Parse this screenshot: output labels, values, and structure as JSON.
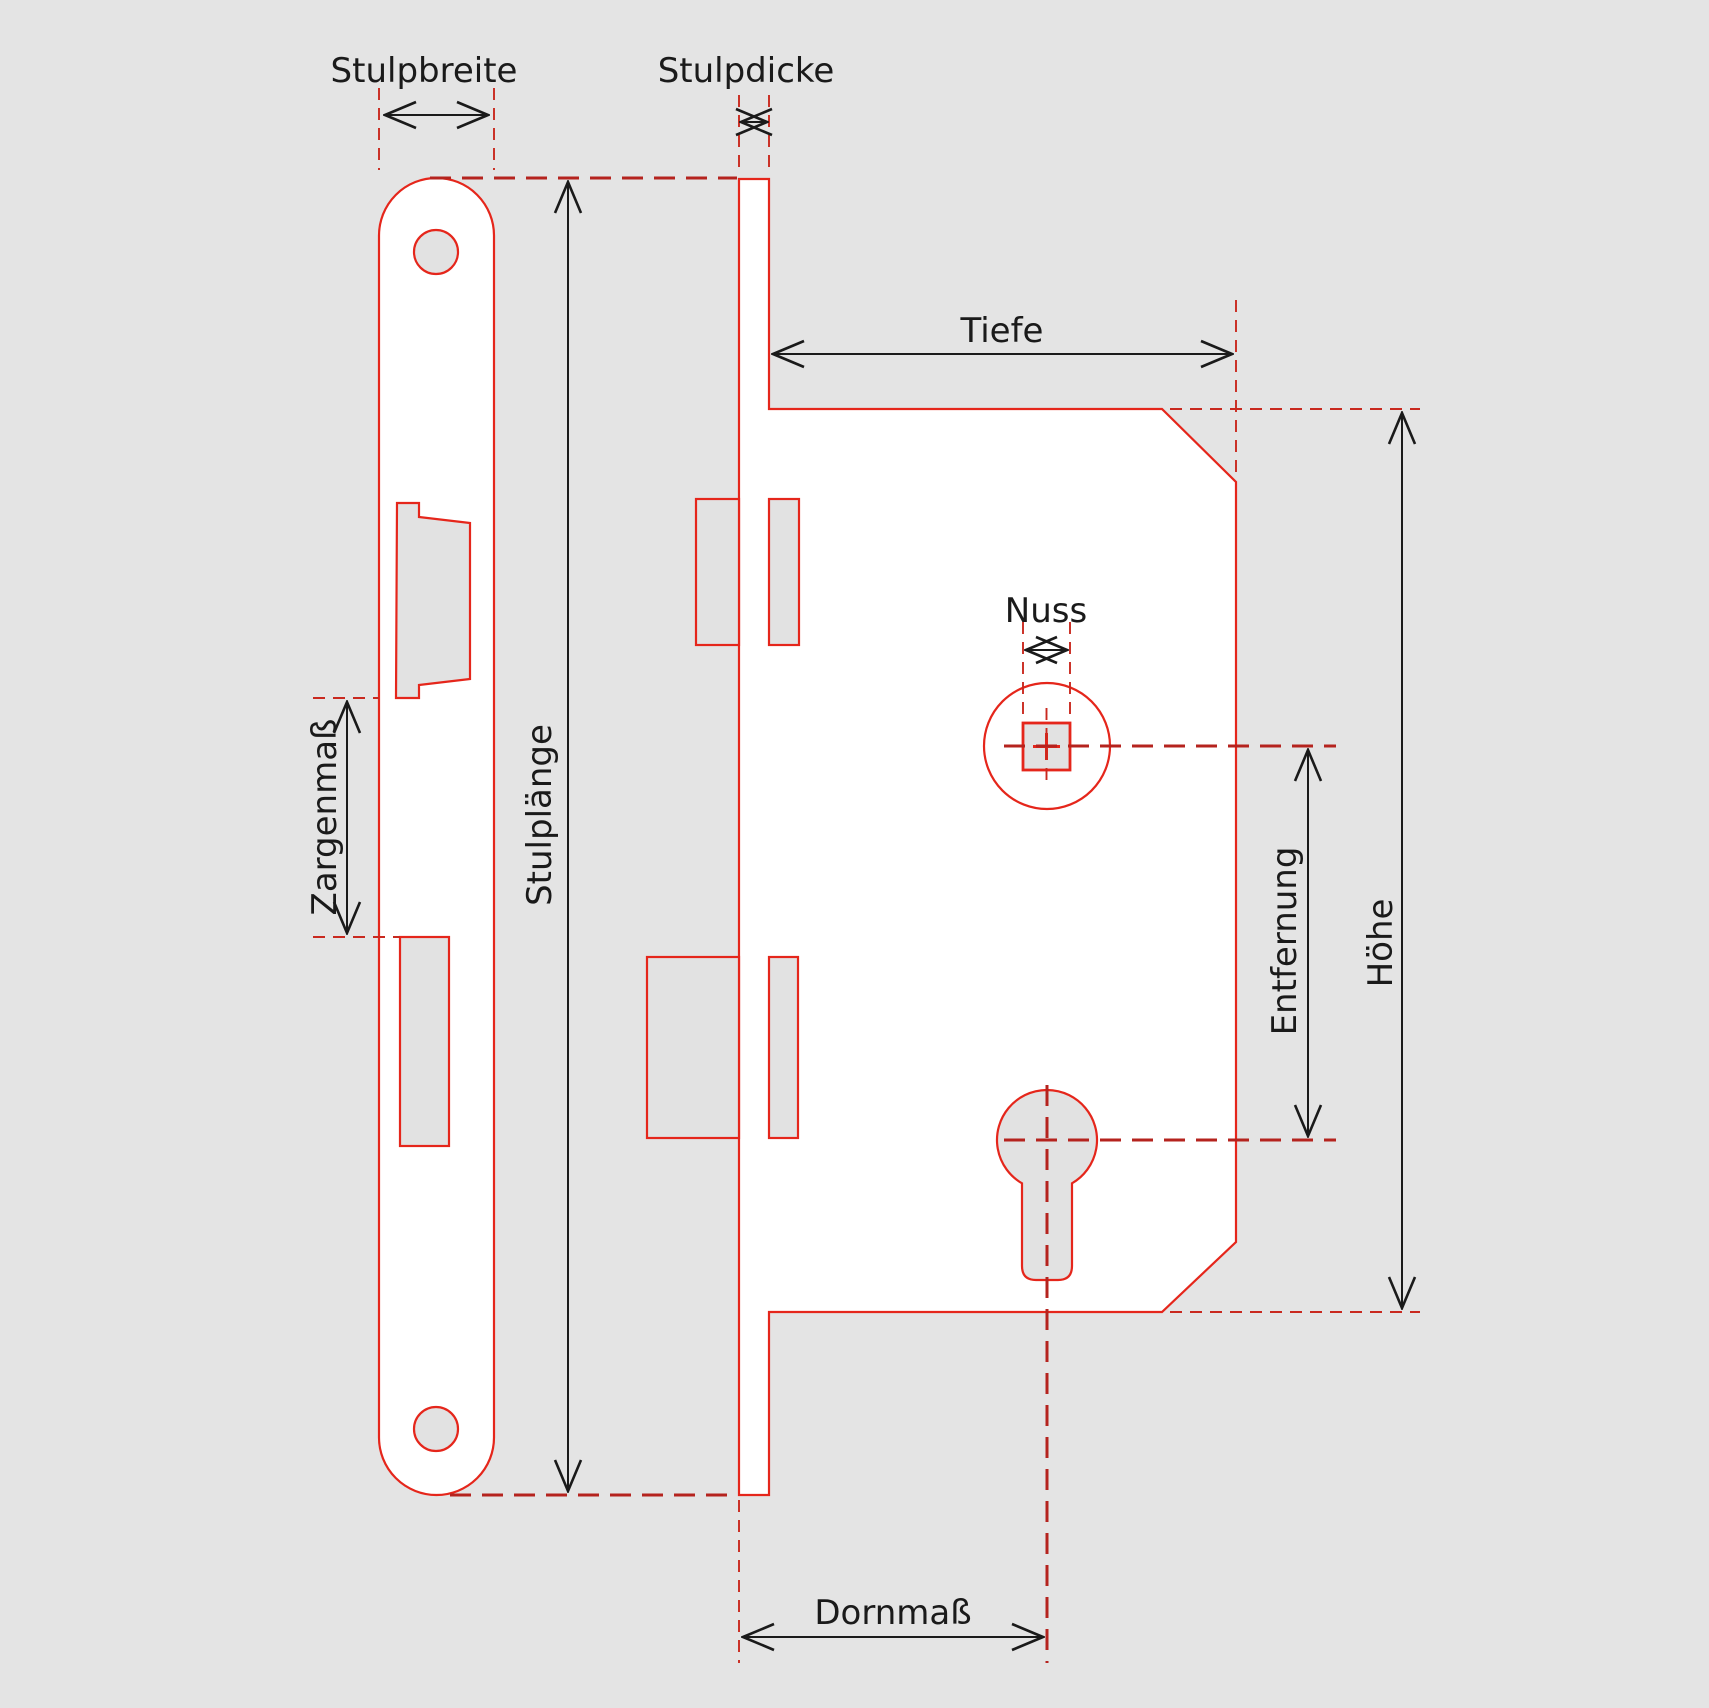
{
  "diagram": {
    "type": "technical-drawing",
    "subject": "mortise-lock-dimension-diagram",
    "labels": {
      "stulpbreite": "Stulpbreite",
      "stulpdicke": "Stulpdicke",
      "stulplaenge": "Stulplänge",
      "zargenmass": "Zargenmaß",
      "tiefe": "Tiefe",
      "nuss": "Nuss",
      "entfernung": "Entfernung",
      "hoehe": "Höhe",
      "dornmass": "Dornmaß"
    },
    "colors": {
      "background": "#e4e4e4",
      "drawing_red": "#e5261b",
      "dashed_red": "#c3241c",
      "dimension_black": "#1a1a1a",
      "shape_fill": "#ffffff",
      "hole_fill": "#e2e2e2"
    }
  }
}
